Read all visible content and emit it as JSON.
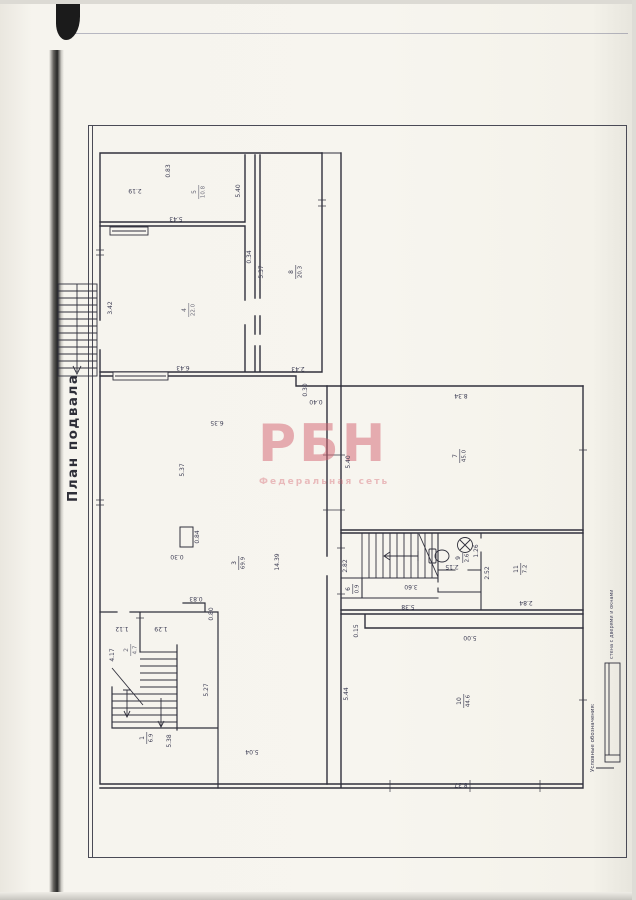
{
  "document": {
    "title": "План подвала"
  },
  "watermark": {
    "brand": "РБН",
    "subtitle": "Федеральная сеть",
    "color": "#d4626f"
  },
  "legend": {
    "title": "Условные обозначения:",
    "wall_symbol_caption": "стена с дверями и окнами"
  },
  "rooms": [
    {
      "number": "1",
      "area": "6.9"
    },
    {
      "number": "2",
      "area": "4.7"
    },
    {
      "number": "3",
      "area": "69.9"
    },
    {
      "number": "4",
      "area": "22.0"
    },
    {
      "number": "5",
      "area": "10.8"
    },
    {
      "number": "6",
      "area": "0.9"
    },
    {
      "number": "7",
      "area": "45.0"
    },
    {
      "number": "8",
      "area": "20.3"
    },
    {
      "number": "9",
      "area": "2.6"
    },
    {
      "number": "10",
      "area": "44.6"
    },
    {
      "number": "11",
      "area": "7.2"
    }
  ],
  "dimensions": {
    "d219": "2.19",
    "d083a": "0.83",
    "d540a": "5.40",
    "d543": "5.43",
    "d342": "3.42",
    "d643": "6.43",
    "d537a": "5.37",
    "d243": "2.43",
    "d034": "0.34",
    "d030a": "0.30",
    "d040": "0.40",
    "d635": "6.35",
    "d537b": "5.37",
    "d1439": "14.39",
    "d084": "0.84",
    "d030b": "0.30",
    "d504": "5.04",
    "d527": "5.27",
    "d834": "8.34",
    "d540b": "5.40",
    "d015": "0.15",
    "d500": "5.00",
    "d544": "5.44",
    "d837": "8.37",
    "d282": "2.82",
    "d360": "3.60",
    "d538a": "5.38",
    "d215": "2.15",
    "d126": "1.26",
    "d252": "2.52",
    "d284": "2.84",
    "d083b": "0.83",
    "d080": "0.80",
    "d112": "1.12",
    "d129": "1.29",
    "d417": "4.17",
    "d538b": "5.38"
  }
}
